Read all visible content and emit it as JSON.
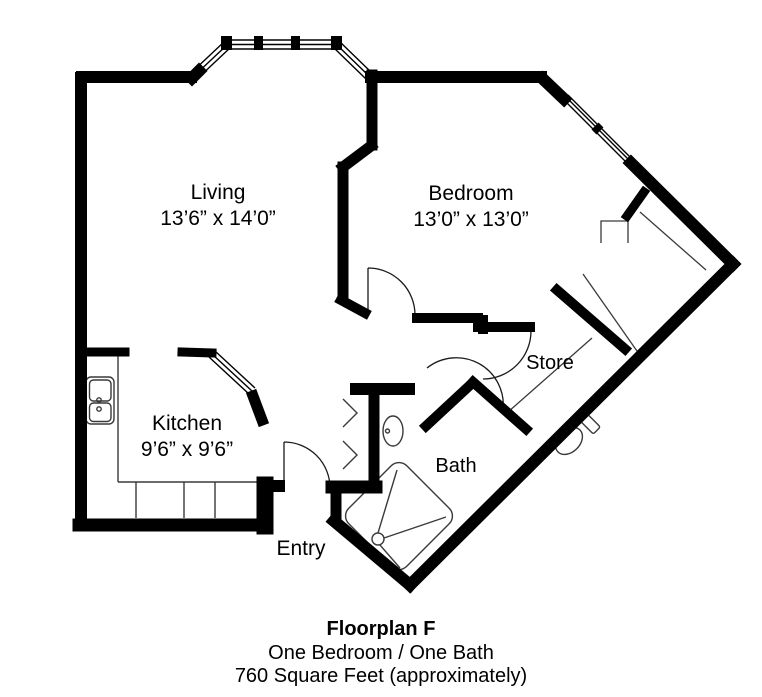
{
  "floorplan": {
    "rooms": [
      {
        "name": "Living",
        "dimensions": "13’6” x 14’0”"
      },
      {
        "name": "Bedroom",
        "dimensions": "13’0” x 13’0”"
      },
      {
        "name": "Kitchen",
        "dimensions": "9’6” x 9’6”"
      },
      {
        "name": "Store",
        "dimensions": ""
      },
      {
        "name": "Bath",
        "dimensions": ""
      },
      {
        "name": "Entry",
        "dimensions": ""
      }
    ],
    "caption": {
      "title": "Floorplan F",
      "line2": "One Bedroom / One Bath",
      "line3": "760 Square Feet (approximately)"
    },
    "colors": {
      "walls": "#000000",
      "background": "#ffffff",
      "fixture_lines": "#3a3a3a"
    },
    "fixtures": [
      "bay-window",
      "bedroom-window",
      "kitchen-pass-through",
      "kitchen-sink",
      "kitchen-counter",
      "hall-closet-bifold-doors",
      "bathroom-sink",
      "toilet",
      "shower",
      "bedroom-closet-rails",
      "door-swings"
    ]
  }
}
